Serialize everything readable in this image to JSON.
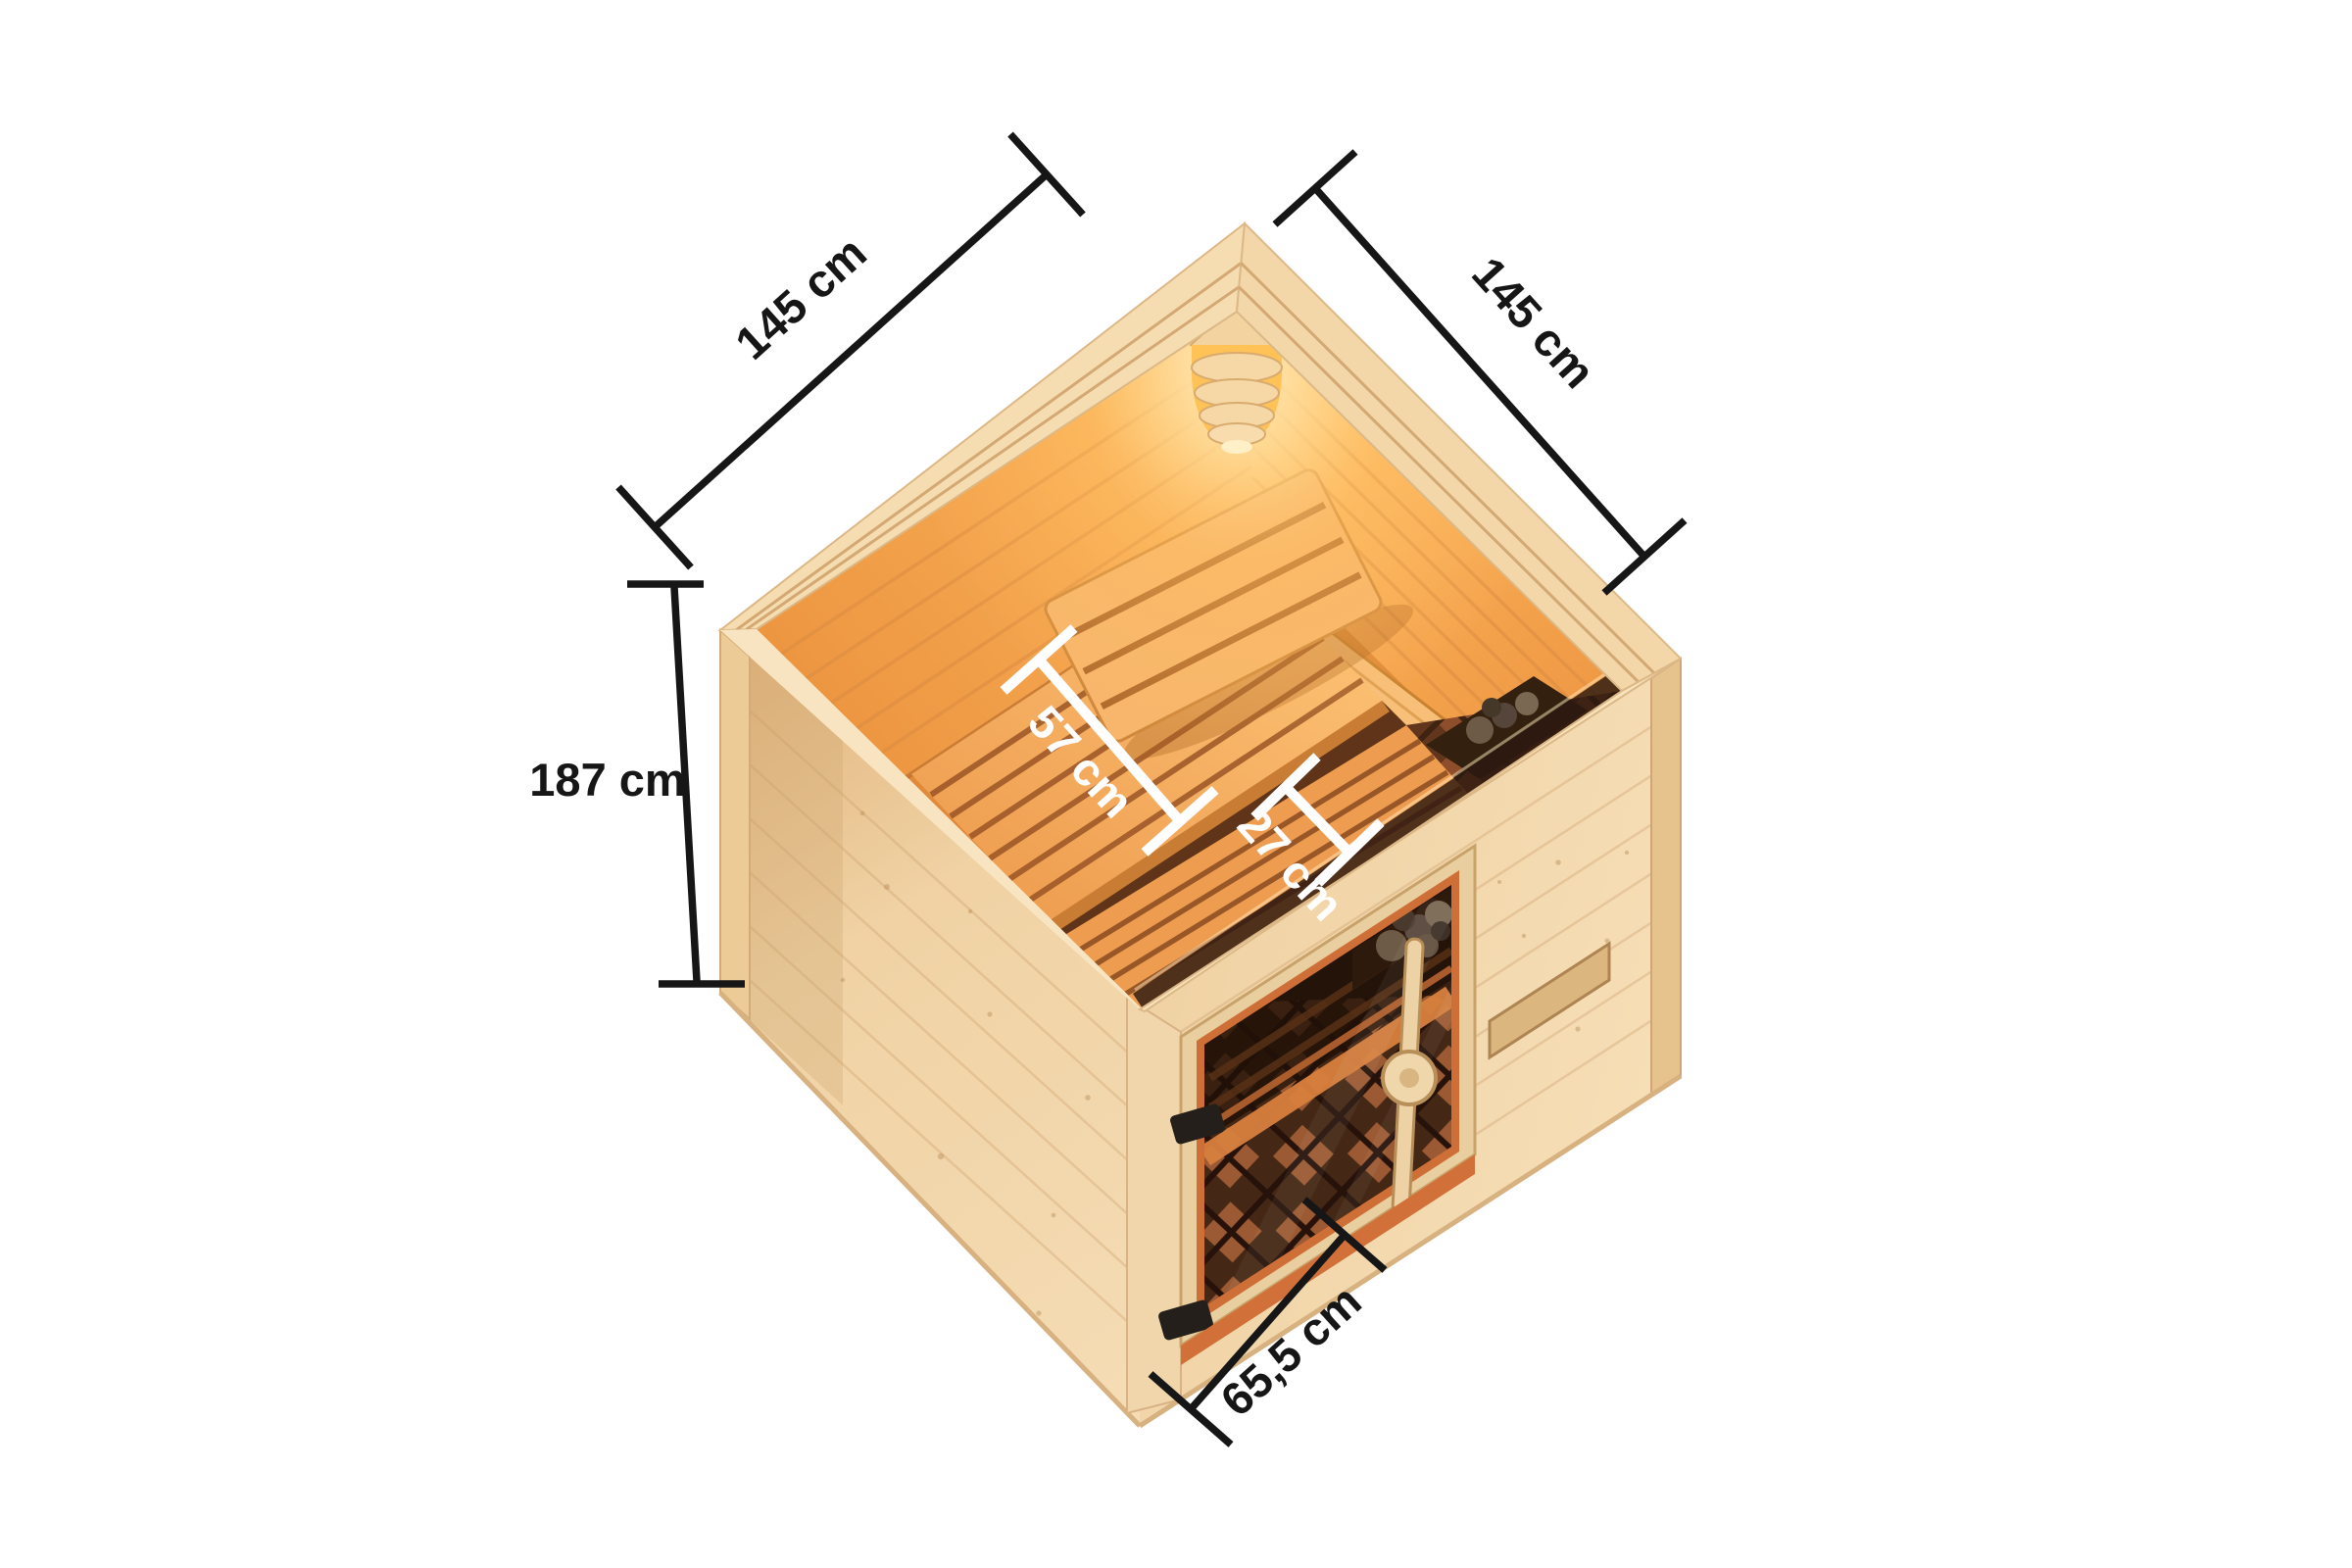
{
  "annotations": {
    "width_left": "145 cm",
    "width_right": "145 cm",
    "height": "187 cm",
    "bench_depth": "57 cm",
    "step_depth": "27 cm",
    "door_width": "65,5 cm"
  },
  "colors": {
    "background": "#ffffff",
    "dimension_line": "#161616",
    "dimension_line_light": "#ffffff",
    "wood_exterior": "#f2d6ab",
    "wood_interior_lit": "#f5a253",
    "lamp_glow": "#ffc257",
    "door_glass": "#3a2013",
    "door_frame": "#cf6f38"
  }
}
